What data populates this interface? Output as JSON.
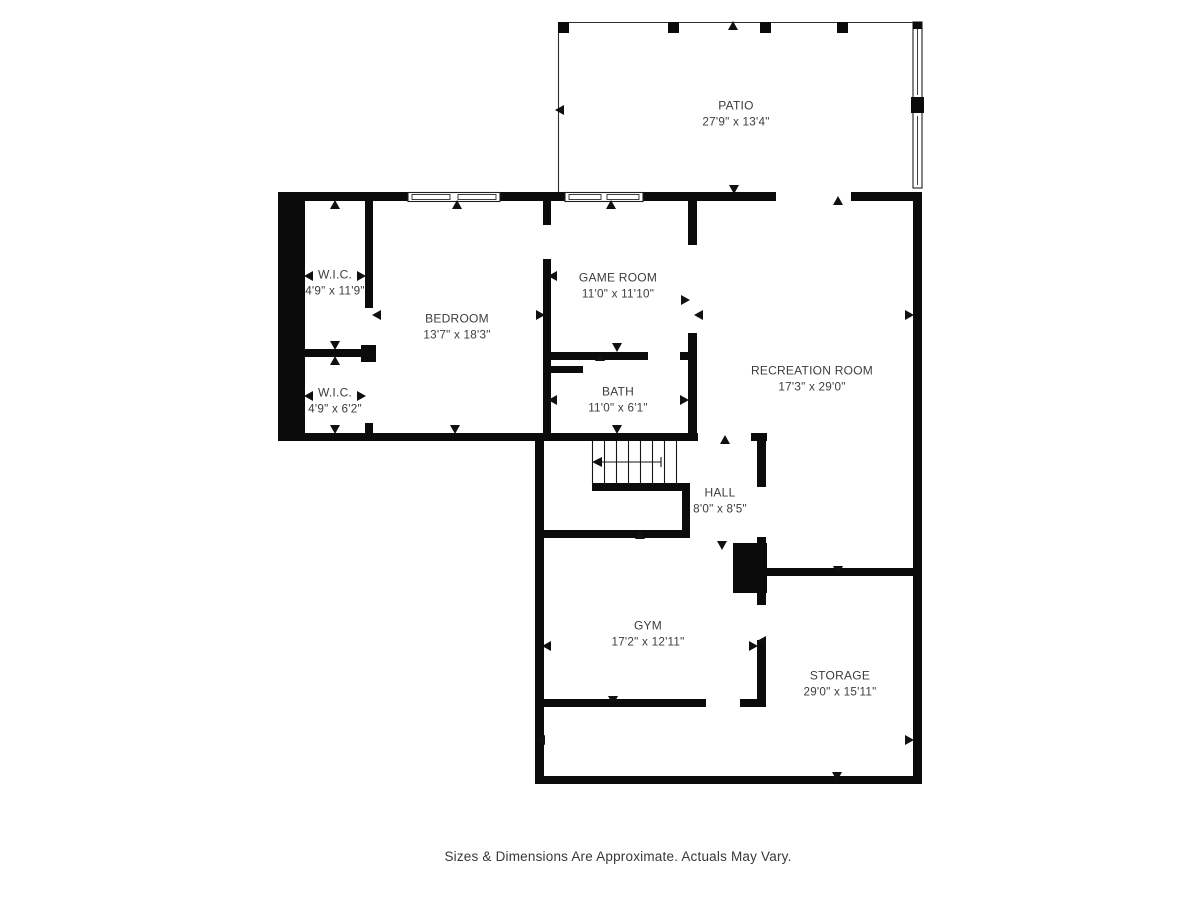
{
  "rooms": {
    "patio": {
      "name": "PATIO",
      "dims": "27'9\" x 13'4\""
    },
    "wic_upper": {
      "name": "W.I.C.",
      "dims": "4'9\" x 11'9\""
    },
    "wic_lower": {
      "name": "W.I.C.",
      "dims": "4'9\" x 6'2\""
    },
    "bedroom": {
      "name": "BEDROOM",
      "dims": "13'7\" x 18'3\""
    },
    "game_room": {
      "name": "GAME ROOM",
      "dims": "11'0\" x 11'10\""
    },
    "bath": {
      "name": "BATH",
      "dims": "11'0\" x 6'1\""
    },
    "recreation_room": {
      "name": "RECREATION ROOM",
      "dims": "17'3\" x 29'0\""
    },
    "hall": {
      "name": "HALL",
      "dims": "8'0\" x 8'5\""
    },
    "gym": {
      "name": "GYM",
      "dims": "17'2\" x 12'11\""
    },
    "storage": {
      "name": "STORAGE",
      "dims": "29'0\" x 15'11\""
    }
  },
  "footer": {
    "disclaimer": "Sizes & Dimensions Are Approximate. Actuals May Vary."
  },
  "colors": {
    "wall": "#0b0b0b",
    "thin_line": "#2e2e2e",
    "label_text": "#3d3d3d",
    "background": "#ffffff"
  }
}
